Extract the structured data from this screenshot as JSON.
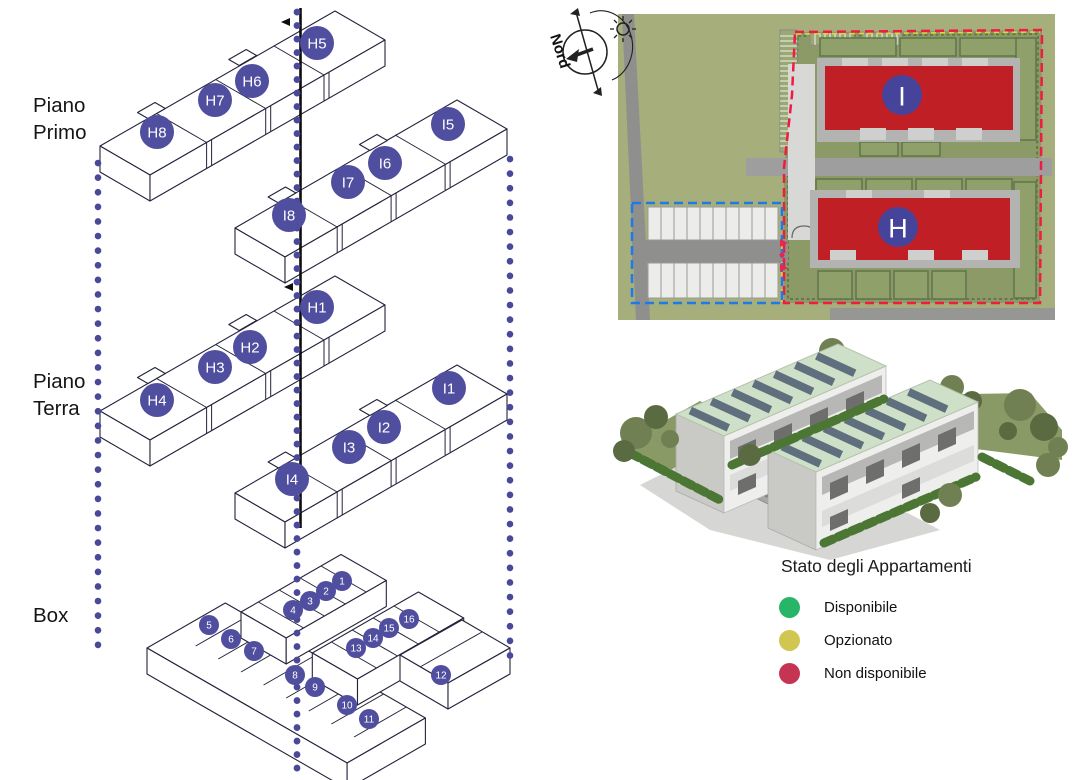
{
  "palette": {
    "unit_circle": "#504e9e",
    "dot_line": "#4a4899",
    "section_line": "#0d0d0d",
    "plan_building_red": "#c02025",
    "plan_circle_blue": "#46449a",
    "boundary_red": "#ee1c40",
    "boundary_blue": "#1e7ae8",
    "boundary_yellow": "#ded63f"
  },
  "levels": [
    {
      "id": "piano-primo",
      "label_lines": [
        "Piano",
        "Primo"
      ],
      "unit_radius": 17,
      "font_size": 15,
      "units": [
        {
          "id": "H5",
          "x": 317,
          "y": 43
        },
        {
          "id": "H6",
          "x": 252,
          "y": 81
        },
        {
          "id": "H7",
          "x": 215,
          "y": 100
        },
        {
          "id": "H8",
          "x": 157,
          "y": 132
        },
        {
          "id": "I5",
          "x": 448,
          "y": 124
        },
        {
          "id": "I6",
          "x": 385,
          "y": 163
        },
        {
          "id": "I7",
          "x": 348,
          "y": 182
        },
        {
          "id": "I8",
          "x": 289,
          "y": 215
        }
      ]
    },
    {
      "id": "piano-terra",
      "label_lines": [
        "Piano",
        "Terra"
      ],
      "unit_radius": 17,
      "font_size": 15,
      "units": [
        {
          "id": "H1",
          "x": 317,
          "y": 307
        },
        {
          "id": "H2",
          "x": 250,
          "y": 347
        },
        {
          "id": "H3",
          "x": 215,
          "y": 367
        },
        {
          "id": "H4",
          "x": 157,
          "y": 400
        },
        {
          "id": "I1",
          "x": 449,
          "y": 388
        },
        {
          "id": "I2",
          "x": 384,
          "y": 427
        },
        {
          "id": "I3",
          "x": 349,
          "y": 447
        },
        {
          "id": "I4",
          "x": 292,
          "y": 479
        }
      ]
    },
    {
      "id": "box",
      "label_lines": [
        "Box"
      ],
      "unit_radius": 10,
      "font_size": 10,
      "units": [
        {
          "id": "1",
          "x": 342,
          "y": 581
        },
        {
          "id": "2",
          "x": 326,
          "y": 591
        },
        {
          "id": "3",
          "x": 310,
          "y": 601
        },
        {
          "id": "4",
          "x": 293,
          "y": 610
        },
        {
          "id": "5",
          "x": 209,
          "y": 625
        },
        {
          "id": "6",
          "x": 231,
          "y": 639
        },
        {
          "id": "7",
          "x": 254,
          "y": 651
        },
        {
          "id": "8",
          "x": 295,
          "y": 675
        },
        {
          "id": "9",
          "x": 315,
          "y": 687
        },
        {
          "id": "10",
          "x": 347,
          "y": 705
        },
        {
          "id": "11",
          "x": 369,
          "y": 719
        },
        {
          "id": "12",
          "x": 441,
          "y": 675
        },
        {
          "id": "13",
          "x": 356,
          "y": 648
        },
        {
          "id": "14",
          "x": 373,
          "y": 638
        },
        {
          "id": "15",
          "x": 389,
          "y": 628
        },
        {
          "id": "16",
          "x": 409,
          "y": 619
        }
      ]
    }
  ],
  "site_plan": {
    "compass_label": "Nord",
    "buildings": [
      {
        "id": "I",
        "x": 372,
        "y": 95
      },
      {
        "id": "H",
        "x": 368,
        "y": 227
      }
    ]
  },
  "legend": {
    "title": "Stato degli Appartamenti",
    "items": [
      {
        "label": "Disponibile",
        "color": "#27b567"
      },
      {
        "label": "Opzionato",
        "color": "#d2c653"
      },
      {
        "label": "Non disponibile",
        "color": "#c53553"
      }
    ]
  }
}
